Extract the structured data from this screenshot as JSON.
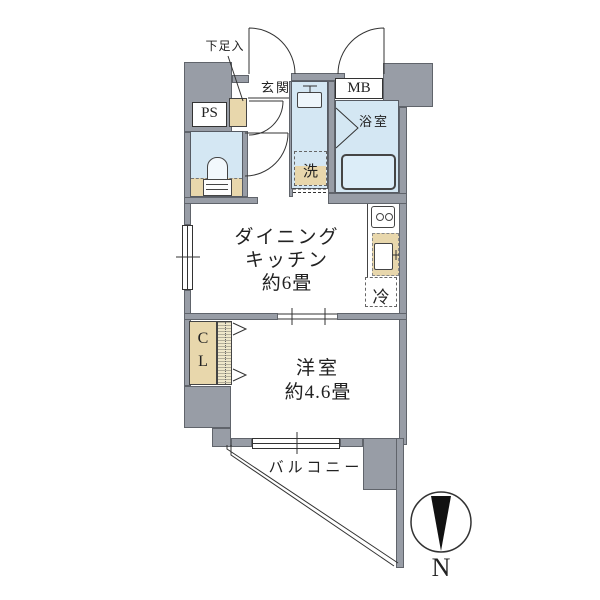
{
  "plan": {
    "labels": {
      "shoe_cabinet": "下足入",
      "entrance": "玄関",
      "pipe_space": "PS",
      "meter_box": "MB",
      "bathroom": "浴室",
      "laundry": "洗",
      "dk_line1": "ダイニング",
      "dk_line2": "キッチン",
      "dk_line3": "約6畳",
      "refrigerator": "冷",
      "closet_line1": "C",
      "closet_line2": "L",
      "western_room_line1": "洋室",
      "western_room_line2": "約4.6畳",
      "balcony": "バルコニー",
      "compass_north": "N"
    },
    "colors": {
      "wall": "#989da6",
      "wall_border": "#60646b",
      "water_room": "#d4e7f3",
      "tatami_tan": "#e8d7ac",
      "bathtub": "#dcedf8",
      "line": "#333333",
      "text": "#222222"
    }
  }
}
